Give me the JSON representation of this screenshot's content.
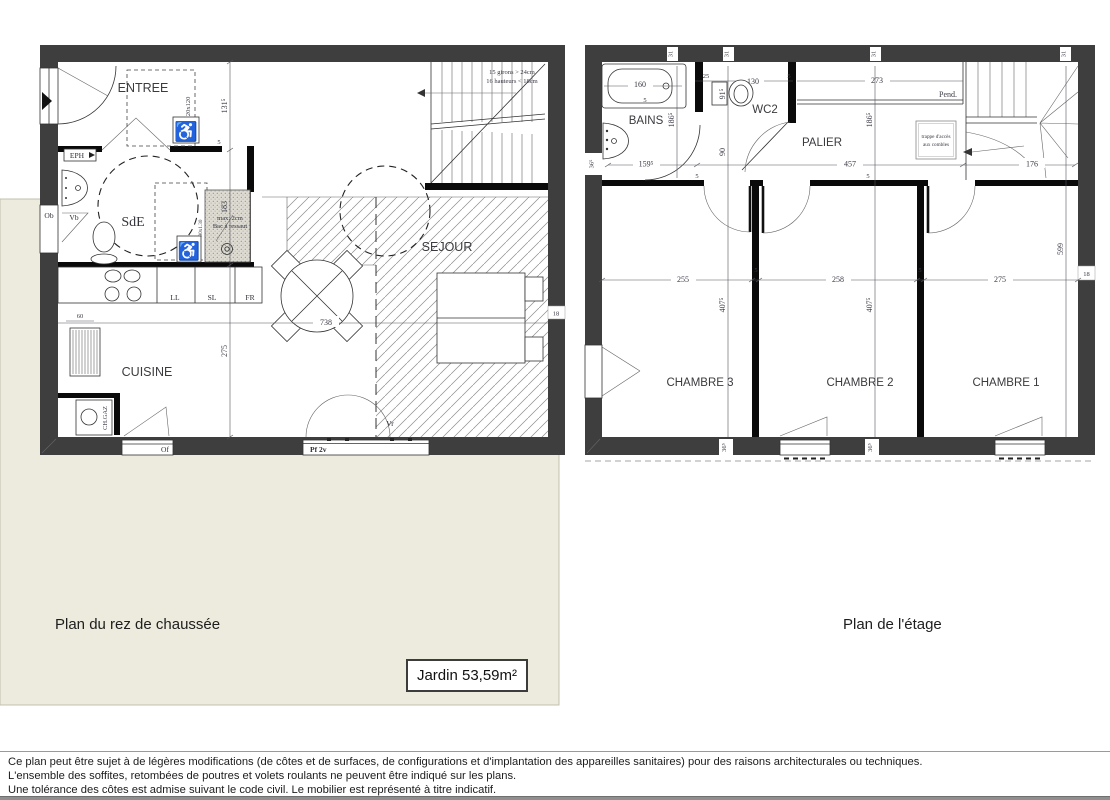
{
  "captions": {
    "ground": "Plan du rez de chaussée",
    "upper": "Plan de l'étage",
    "garden": "Jardin 53,59m²"
  },
  "footer": {
    "line1": "Ce plan peut être sujet à de légères modifications (de côtes et de surfaces, de configurations  et d'implantation des appareilles sanitaires) pour des raisons architecturales ou techniques.",
    "line2": "L'ensemble des soffites, retombées de poutres et volets roulants ne peuvent être indiqué sur les plans.",
    "line3": "Une tolérance des côtes est admise suivant le code civil. Le mobilier est représenté à titre indicatif."
  },
  "icons": {
    "wheelchair": "♿"
  },
  "ground_floor": {
    "rooms": {
      "entree": "ENTREE",
      "sde": "SdE",
      "cuisine": "CUISINE",
      "sejour": "SEJOUR"
    },
    "stairs": {
      "note1": "15 girons > 24cm",
      "note2": "16 hauteurs < 18cm"
    },
    "labels": {
      "ll": "LL",
      "sl": "SL",
      "fr": "FR",
      "lv": "LV",
      "chgaz": "CH.GAZ",
      "ob": "Ob",
      "vb": "Vb",
      "of": "Of",
      "pf2v": "Pf 2v",
      "vr": "Vr",
      "eph": "EPH",
      "clearance": "120x120",
      "shower_size": "90x1.30",
      "shower_note1": "max. 2cm",
      "shower_note2": "Bac à ressaut"
    },
    "dims": {
      "d131": "131⁵",
      "d183": "183",
      "d275": "275",
      "d738": "738",
      "d60": "60",
      "d18": "18",
      "d5": "5"
    }
  },
  "upper_floor": {
    "rooms": {
      "bains": "BAINS",
      "wc2": "WC2",
      "palier": "PALIER",
      "ch1": "CHAMBRE 1",
      "ch2": "CHAMBRE 2",
      "ch3": "CHAMBRE 3"
    },
    "labels": {
      "pend": "Pend.",
      "trappe1": "trappe d'accès",
      "trappe2": "aux combles"
    },
    "dims": {
      "d160": "160",
      "d25": "25",
      "d130": "130",
      "d273": "273",
      "d186": "186⁵",
      "d91": "91⁵",
      "d90": "90",
      "d159": "159⁵",
      "d457": "457",
      "d176": "176",
      "d255": "255",
      "d258": "258",
      "d275": "275",
      "d407": "407⁵",
      "d599": "599",
      "d36": "36⁵",
      "d31": "31",
      "d18": "18",
      "d5": "5"
    }
  }
}
